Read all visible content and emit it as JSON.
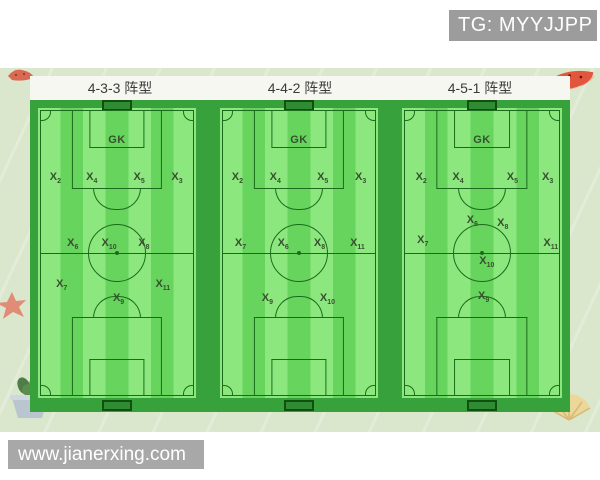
{
  "page": {
    "tg_badge": "TG: MYYJJPP",
    "watermark": "www.jianerxing.com"
  },
  "colors": {
    "badge_bg": "#9c9c9c",
    "watermark_bg": "#a8a8a8",
    "panel_bg": "#dbe7cd",
    "titlebar_bg": "#f7f7f1",
    "title_text": "#3b3b3b",
    "band_green": "#37a23c",
    "stripe_light": "#8ce87e",
    "stripe_dark": "#67d45e",
    "line_green": "#1c6b1c",
    "goal_fill": "#2f8c33",
    "label_color": "#37502f"
  },
  "formations": [
    {
      "key": "433",
      "title": "4-3-3 阵型",
      "gk_label": "GK",
      "players": [
        {
          "base": "X",
          "sub": "2",
          "x": 11,
          "y": 24
        },
        {
          "base": "X",
          "sub": "4",
          "x": 34,
          "y": 24
        },
        {
          "base": "X",
          "sub": "5",
          "x": 64,
          "y": 24
        },
        {
          "base": "X",
          "sub": "3",
          "x": 88,
          "y": 24
        },
        {
          "base": "X",
          "sub": "6",
          "x": 22,
          "y": 47
        },
        {
          "base": "X",
          "sub": "10",
          "x": 45,
          "y": 47
        },
        {
          "base": "X",
          "sub": "8",
          "x": 67,
          "y": 47
        },
        {
          "base": "X",
          "sub": "7",
          "x": 15,
          "y": 61
        },
        {
          "base": "X",
          "sub": "9",
          "x": 51,
          "y": 66
        },
        {
          "base": "X",
          "sub": "11",
          "x": 79,
          "y": 61
        }
      ]
    },
    {
      "key": "442",
      "title": "4-4-2 阵型",
      "gk_label": "GK",
      "players": [
        {
          "base": "X",
          "sub": "2",
          "x": 11,
          "y": 24
        },
        {
          "base": "X",
          "sub": "4",
          "x": 35,
          "y": 24
        },
        {
          "base": "X",
          "sub": "5",
          "x": 65,
          "y": 24
        },
        {
          "base": "X",
          "sub": "3",
          "x": 89,
          "y": 24
        },
        {
          "base": "X",
          "sub": "7",
          "x": 13,
          "y": 47
        },
        {
          "base": "X",
          "sub": "6",
          "x": 40,
          "y": 47
        },
        {
          "base": "X",
          "sub": "8",
          "x": 63,
          "y": 47
        },
        {
          "base": "X",
          "sub": "11",
          "x": 87,
          "y": 47
        },
        {
          "base": "X",
          "sub": "9",
          "x": 30,
          "y": 66
        },
        {
          "base": "X",
          "sub": "10",
          "x": 68,
          "y": 66
        }
      ]
    },
    {
      "key": "451",
      "title": "4-5-1 阵型",
      "gk_label": "GK",
      "players": [
        {
          "base": "X",
          "sub": "2",
          "x": 12,
          "y": 24
        },
        {
          "base": "X",
          "sub": "4",
          "x": 35,
          "y": 24
        },
        {
          "base": "X",
          "sub": "5",
          "x": 69,
          "y": 24
        },
        {
          "base": "X",
          "sub": "3",
          "x": 91,
          "y": 24
        },
        {
          "base": "X",
          "sub": "6",
          "x": 44,
          "y": 39
        },
        {
          "base": "X",
          "sub": "8",
          "x": 63,
          "y": 40
        },
        {
          "base": "X",
          "sub": "7",
          "x": 13,
          "y": 46
        },
        {
          "base": "X",
          "sub": "11",
          "x": 93,
          "y": 47
        },
        {
          "base": "X",
          "sub": "10",
          "x": 53,
          "y": 53
        },
        {
          "base": "X",
          "sub": "9",
          "x": 51,
          "y": 65
        }
      ]
    }
  ],
  "decorations": [
    "watermelon-small-icon",
    "watermelon-slice-icon",
    "starfish-icon",
    "potted-plant-icon",
    "seashell-icon"
  ]
}
